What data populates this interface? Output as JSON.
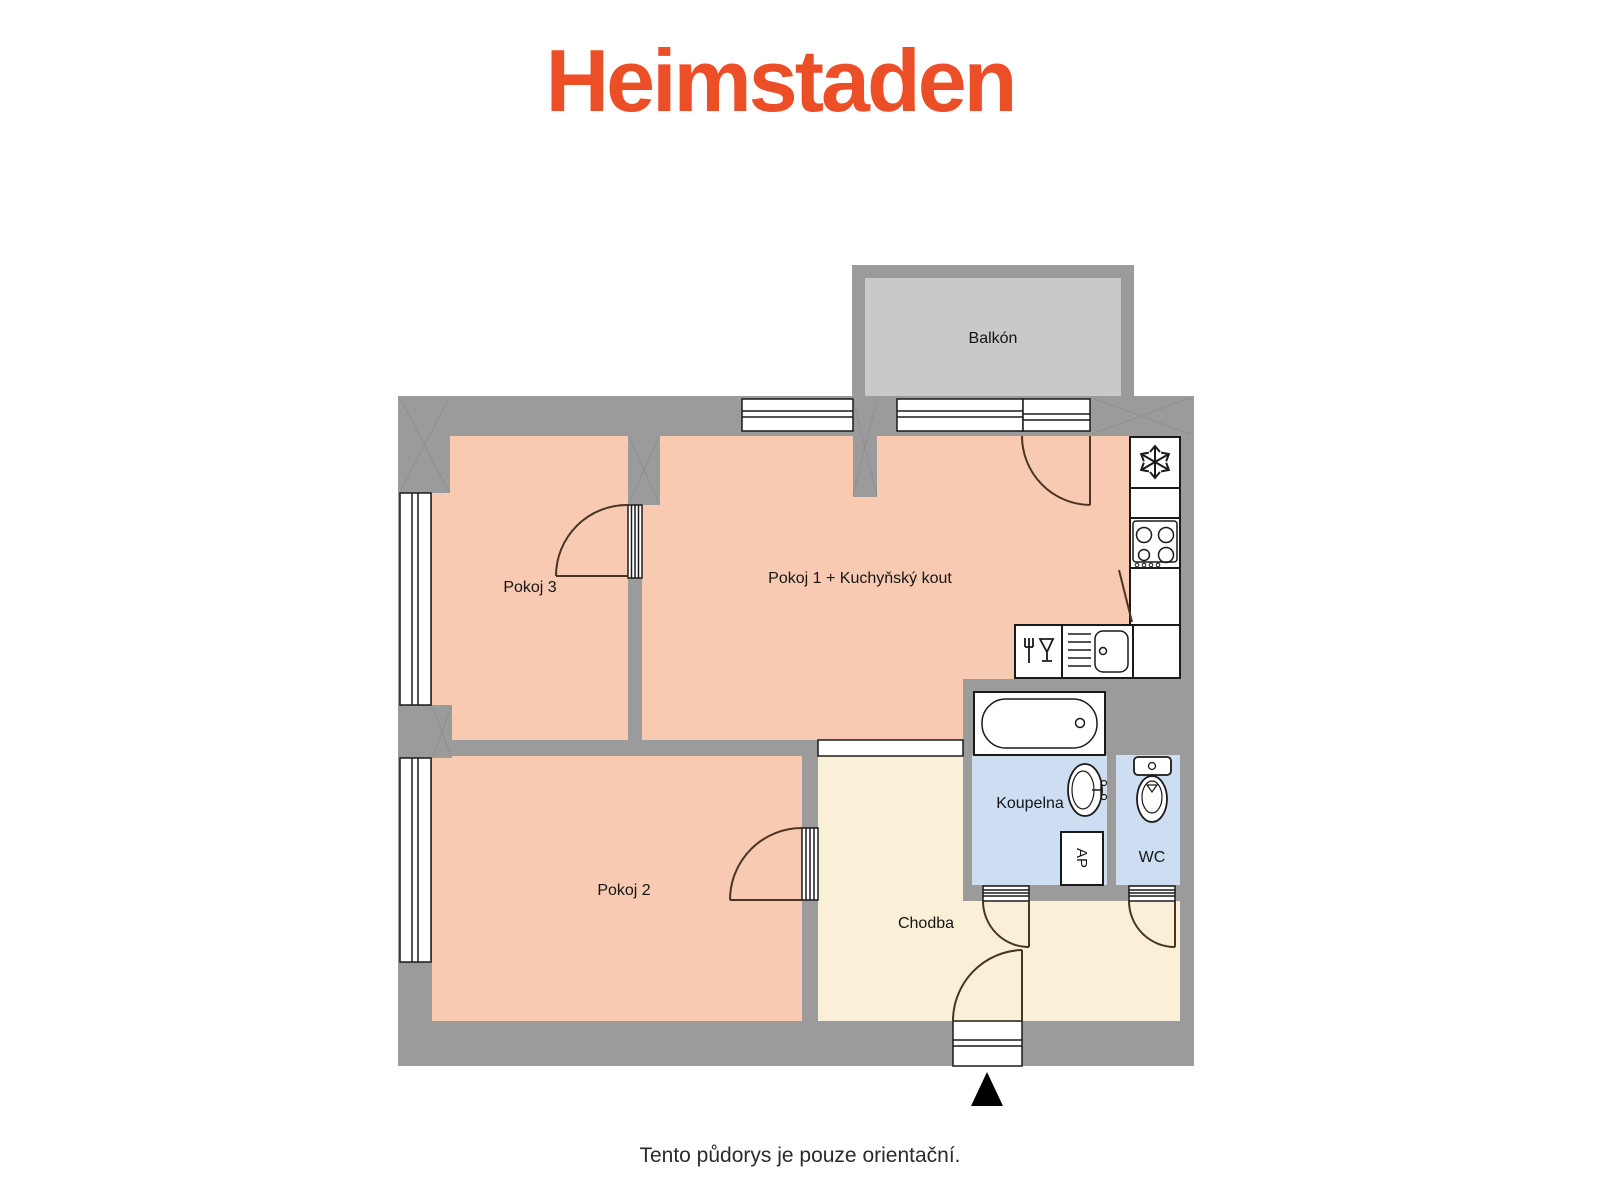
{
  "brand": {
    "logo": "Heimstaden",
    "logo_color": "#ec4e27"
  },
  "plan": {
    "rooms": {
      "balkon": "Balkón",
      "pokoj3": "Pokoj 3",
      "pokoj1": "Pokoj 1 + Kuchyňský kout",
      "pokoj2": "Pokoj 2",
      "koupelna": "Koupelna",
      "wc": "WC",
      "ap": "AP",
      "chodba": "Chodba"
    },
    "colors": {
      "wall": "#9b9b9b",
      "room_floor": "#f8cab2",
      "hallway_floor": "#faf0d8",
      "bathroom_floor": "#cdddf2",
      "balcony_floor": "#c9c9c9",
      "fixture_outline": "#1a1a1a",
      "door_swing": "#4a3423",
      "entrance_marker": "#000000"
    },
    "fixtures": [
      "fridge",
      "stove",
      "kitchen-sink",
      "dishwasher",
      "bathtub",
      "washbasin",
      "toilet",
      "washing-machine"
    ]
  },
  "footer": {
    "disclaimer": "Tento půdorys je pouze orientační."
  }
}
